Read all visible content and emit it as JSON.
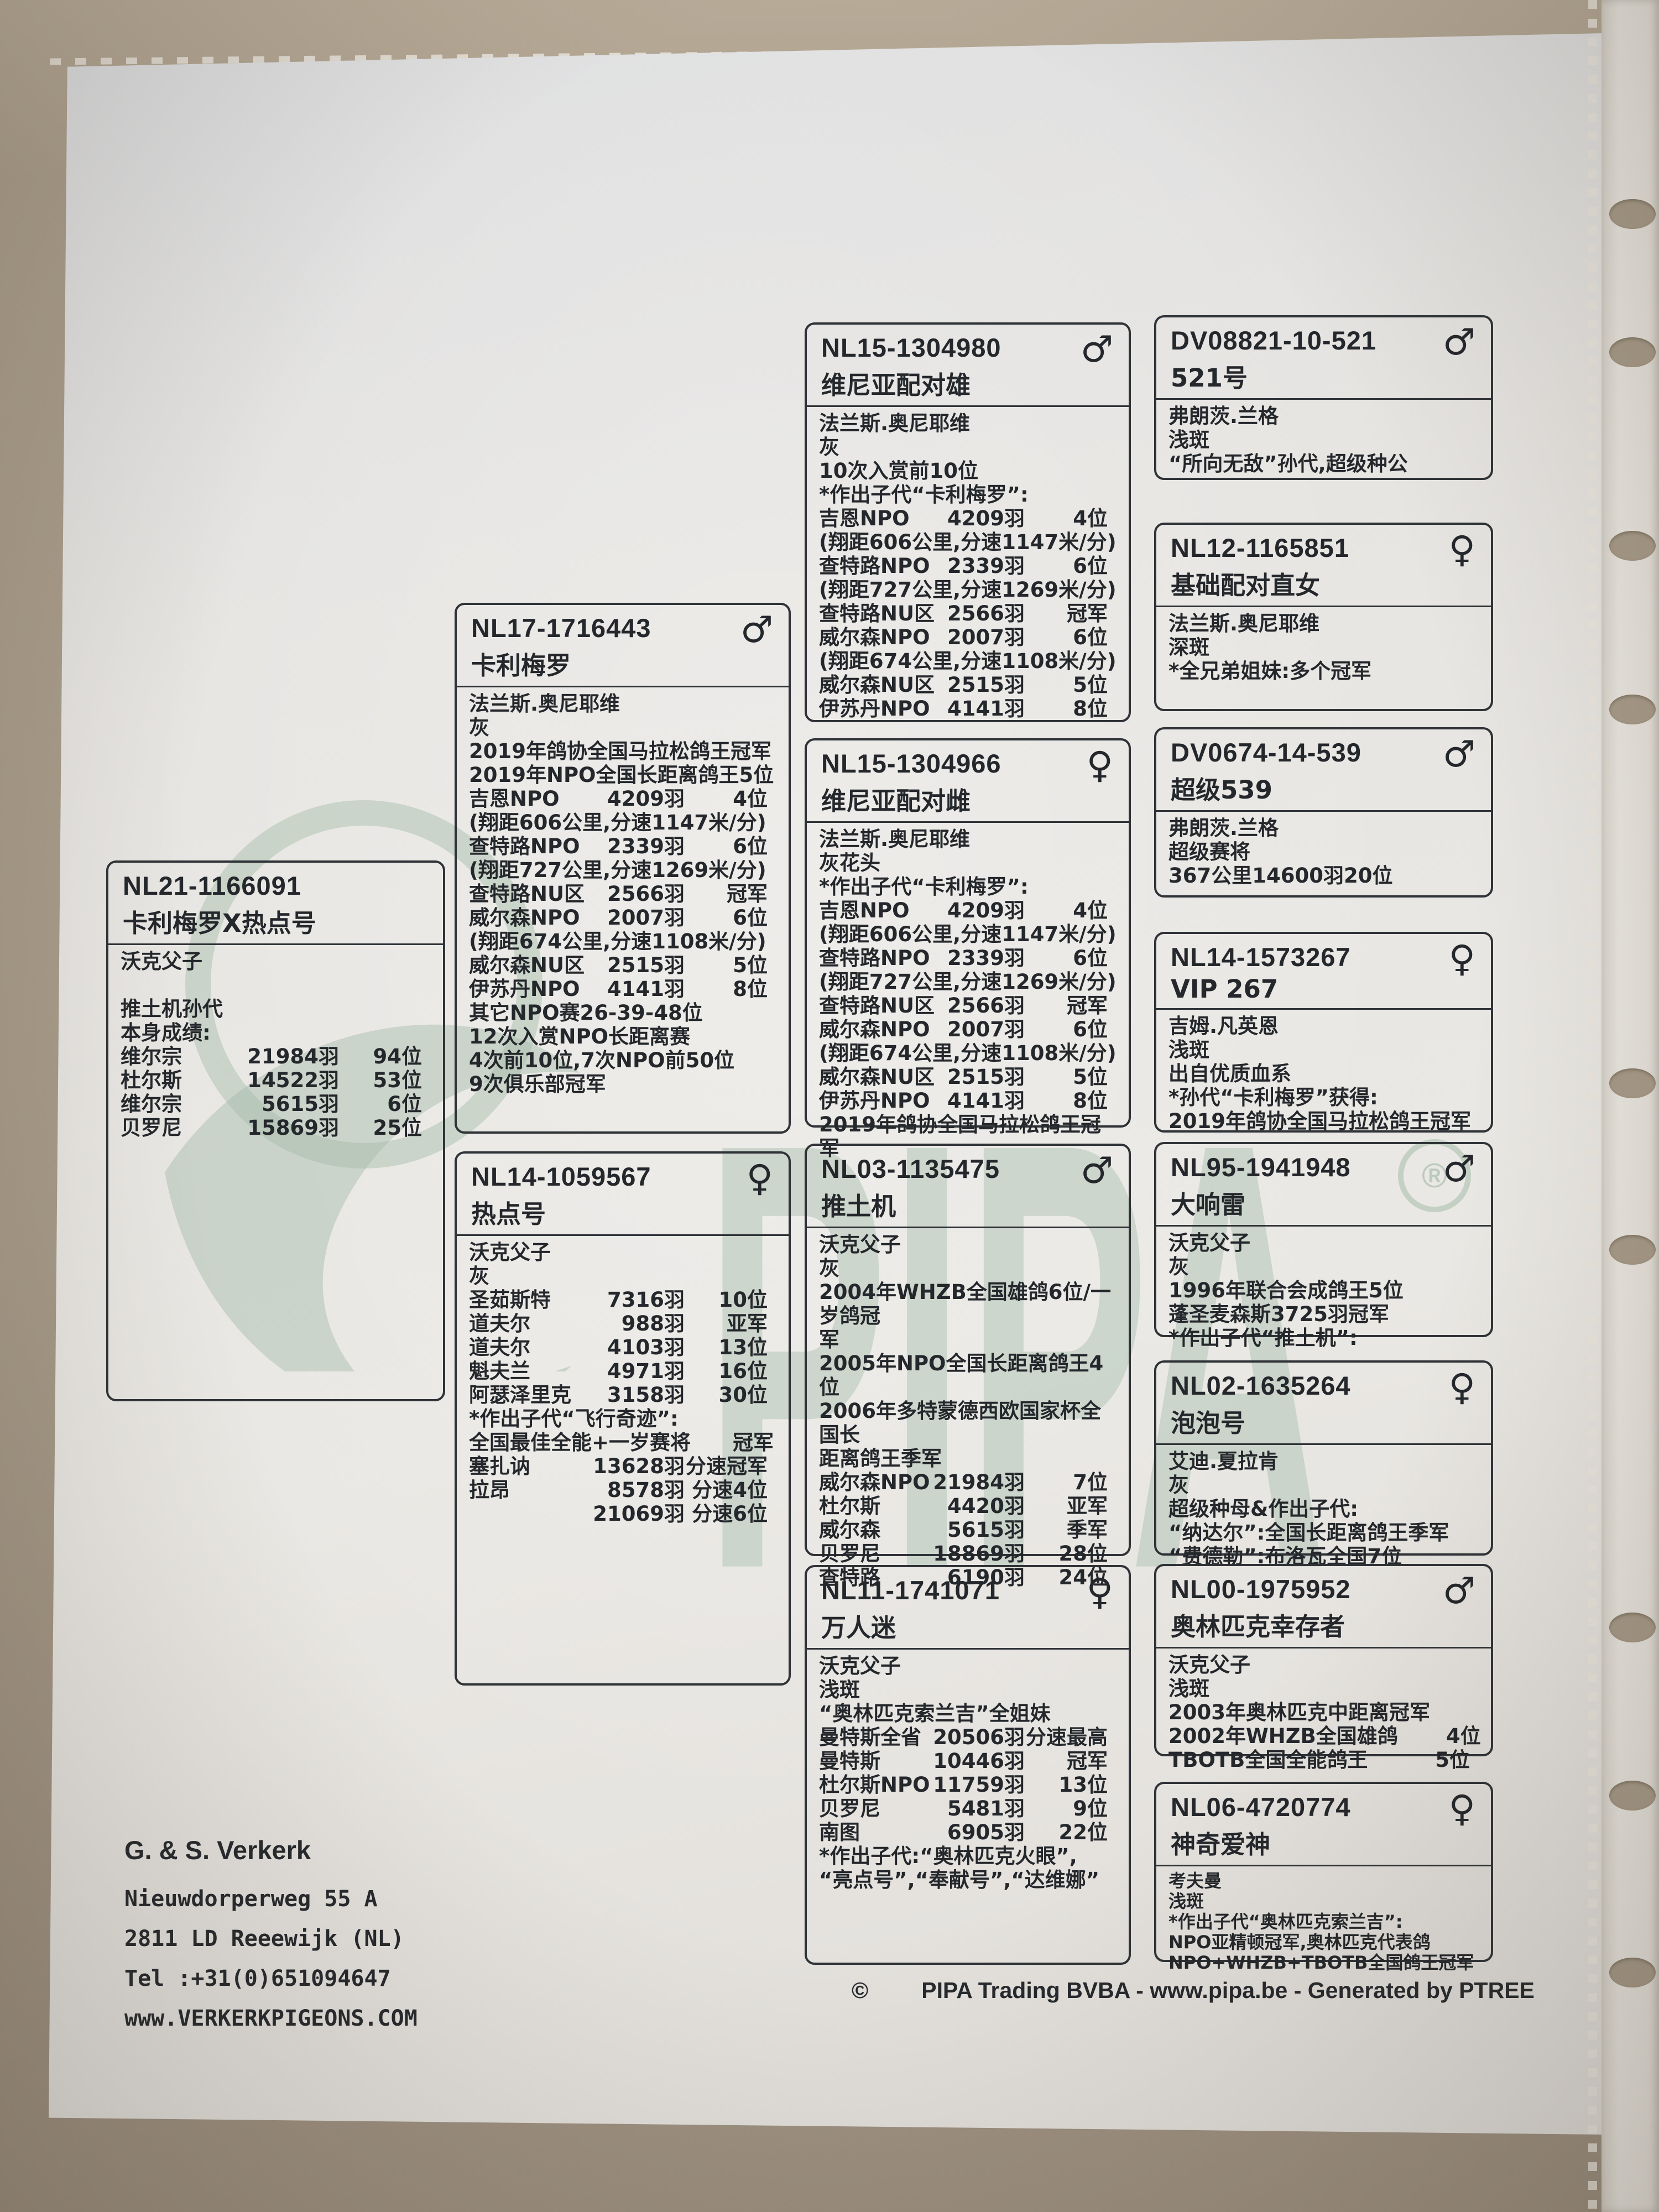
{
  "watermark": {
    "brand": "PIPA",
    "registered": "®"
  },
  "owner": {
    "name": "G. & S. Verkerk",
    "lines": [
      "Nieuwdorperweg 55 A",
      "2811 LD Reeewijk (NL)",
      "Tel :+31(0)651094647",
      "www.VERKERKPIGEONS.COM"
    ]
  },
  "footer": {
    "copyright": "©",
    "text": "PIPA Trading BVBA - www.pipa.be - Generated by PTREE"
  },
  "boxes": [
    {
      "id": "NL21-1166091",
      "title": "卡利梅罗X热点号",
      "sex": "",
      "lines": [
        {
          "t": "沃克父子"
        },
        {
          "t": ""
        },
        {
          "t": "推土机孙代"
        },
        {
          "t": "本身成绩:"
        },
        {
          "c": [
            "维尔宗",
            "21984羽",
            "94位"
          ]
        },
        {
          "c": [
            "杜尔斯",
            "14522羽",
            "53位"
          ]
        },
        {
          "c": [
            "维尔宗",
            "5615羽",
            "6位"
          ]
        },
        {
          "c": [
            "贝罗尼",
            "15869羽",
            "25位"
          ]
        }
      ]
    },
    {
      "id": "NL17-1716443",
      "title": "卡利梅罗",
      "sex": "♂",
      "lines": [
        {
          "t": "法兰斯.奥尼耶维"
        },
        {
          "t": "灰"
        },
        {
          "t": "2019年鸽协全国马拉松鸽王冠军"
        },
        {
          "t": "2019年NPO全国长距离鸽王5位"
        },
        {
          "c": [
            "吉恩NPO",
            "4209羽",
            "4位"
          ]
        },
        {
          "t": "(翔距606公里,分速1147米/分)"
        },
        {
          "c": [
            "查特路NPO",
            "2339羽",
            "6位"
          ]
        },
        {
          "t": "(翔距727公里,分速1269米/分)"
        },
        {
          "c": [
            "查特路NU区",
            "2566羽",
            "冠军"
          ]
        },
        {
          "c": [
            "威尔森NPO",
            "2007羽",
            "6位"
          ]
        },
        {
          "t": "(翔距674公里,分速1108米/分)"
        },
        {
          "c": [
            "威尔森NU区",
            "2515羽",
            "5位"
          ]
        },
        {
          "c": [
            "伊苏丹NPO",
            "4141羽",
            "8位"
          ]
        },
        {
          "t": "其它NPO赛26-39-48位"
        },
        {
          "t": "12次入赏NPO长距离赛"
        },
        {
          "t": "4次前10位,7次NPO前50位"
        },
        {
          "t": "9次俱乐部冠军"
        }
      ]
    },
    {
      "id": "NL14-1059567",
      "title": "热点号",
      "sex": "♀",
      "lines": [
        {
          "t": "沃克父子"
        },
        {
          "t": "灰"
        },
        {
          "c": [
            "圣茹斯特",
            "7316羽",
            "10位"
          ]
        },
        {
          "c": [
            "道夫尔",
            "988羽",
            "亚军"
          ]
        },
        {
          "c": [
            "道夫尔",
            "4103羽",
            "13位"
          ]
        },
        {
          "c": [
            "魁夫兰",
            "4971羽",
            "16位"
          ]
        },
        {
          "c": [
            "阿瑟泽里克",
            "3158羽",
            "30位"
          ]
        },
        {
          "t": "*作出子代“飞行奇迹”:"
        },
        {
          "c": [
            "全国最佳全能+一岁赛将",
            "",
            "冠军"
          ]
        },
        {
          "c": [
            "塞扎讷",
            "13628羽",
            "分速冠军"
          ]
        },
        {
          "c": [
            "拉昂",
            "8578羽",
            "分速4位"
          ]
        },
        {
          "c": [
            "",
            "21069羽",
            "分速6位"
          ]
        }
      ]
    },
    {
      "id": "NL15-1304980",
      "title": "维尼亚配对雄",
      "sex": "♂",
      "lines": [
        {
          "t": "法兰斯.奥尼耶维"
        },
        {
          "t": "灰"
        },
        {
          "t": "10次入赏前10位"
        },
        {
          "t": "*作出子代“卡利梅罗”:"
        },
        {
          "c": [
            "吉恩NPO",
            "4209羽",
            "4位"
          ]
        },
        {
          "t": "(翔距606公里,分速1147米/分)"
        },
        {
          "c": [
            "查特路NPO",
            "2339羽",
            "6位"
          ]
        },
        {
          "t": "(翔距727公里,分速1269米/分)"
        },
        {
          "c": [
            "查特路NU区",
            "2566羽",
            "冠军"
          ]
        },
        {
          "c": [
            "威尔森NPO",
            "2007羽",
            "6位"
          ]
        },
        {
          "t": "(翔距674公里,分速1108米/分)"
        },
        {
          "c": [
            "威尔森NU区",
            "2515羽",
            "5位"
          ]
        },
        {
          "c": [
            "伊苏丹NPO",
            "4141羽",
            "8位"
          ]
        }
      ]
    },
    {
      "id": "NL15-1304966",
      "title": "维尼亚配对雌",
      "sex": "♀",
      "lines": [
        {
          "t": "法兰斯.奥尼耶维"
        },
        {
          "t": "灰花头"
        },
        {
          "t": "*作出子代“卡利梅罗”:"
        },
        {
          "c": [
            "吉恩NPO",
            "4209羽",
            "4位"
          ]
        },
        {
          "t": "(翔距606公里,分速1147米/分)"
        },
        {
          "c": [
            "查特路NPO",
            "2339羽",
            "6位"
          ]
        },
        {
          "t": "(翔距727公里,分速1269米/分)"
        },
        {
          "c": [
            "查特路NU区",
            "2566羽",
            "冠军"
          ]
        },
        {
          "c": [
            "威尔森NPO",
            "2007羽",
            "6位"
          ]
        },
        {
          "t": "(翔距674公里,分速1108米/分)"
        },
        {
          "c": [
            "威尔森NU区",
            "2515羽",
            "5位"
          ]
        },
        {
          "c": [
            "伊苏丹NPO",
            "4141羽",
            "8位"
          ]
        },
        {
          "t": "2019年鸽协全国马拉松鸽王冠军"
        }
      ]
    },
    {
      "id": "NL03-1135475",
      "title": "推土机",
      "sex": "♂",
      "lines": [
        {
          "t": "沃克父子"
        },
        {
          "t": "灰"
        },
        {
          "t": "2004年WHZB全国雄鸽6位/一岁鸽冠"
        },
        {
          "t": "军"
        },
        {
          "t": "2005年NPO全国长距离鸽王4位"
        },
        {
          "t": "2006年多特蒙德西欧国家杯全国长"
        },
        {
          "t": "距离鸽王季军"
        },
        {
          "c": [
            "威尔森NPO",
            "21984羽",
            "7位"
          ]
        },
        {
          "c": [
            "杜尔斯",
            "4420羽",
            "亚军"
          ]
        },
        {
          "c": [
            "威尔森",
            "5615羽",
            "季军"
          ]
        },
        {
          "c": [
            "贝罗尼",
            "18869羽",
            "28位"
          ]
        },
        {
          "c": [
            "查特路",
            "6190羽",
            "24位"
          ]
        }
      ]
    },
    {
      "id": "NL11-1741071",
      "title": "万人迷",
      "sex": "♀",
      "lines": [
        {
          "t": "沃克父子"
        },
        {
          "t": "浅斑"
        },
        {
          "t": "“奥林匹克索兰吉”全姐妹"
        },
        {
          "c": [
            "曼特斯全省",
            "20506羽",
            "分速最高"
          ]
        },
        {
          "c": [
            "曼特斯",
            "10446羽",
            "冠军"
          ]
        },
        {
          "c": [
            "杜尔斯NPO",
            "11759羽",
            "13位"
          ]
        },
        {
          "c": [
            "贝罗尼",
            "5481羽",
            "9位"
          ]
        },
        {
          "c": [
            "南图",
            "6905羽",
            "22位"
          ]
        },
        {
          "t": "*作出子代:“奥林匹克火眼”,"
        },
        {
          "t": "“亮点号”,“奉献号”,“达维娜”"
        }
      ]
    },
    {
      "id": "DV08821-10-521",
      "title": "521号",
      "sex": "♂",
      "lines": [
        {
          "t": "弗朗茨.兰格"
        },
        {
          "t": "浅斑"
        },
        {
          "t": "“所向无敌”孙代,超级种公"
        }
      ]
    },
    {
      "id": "NL12-1165851",
      "title": "基础配对直女",
      "sex": "♀",
      "lines": [
        {
          "t": "法兰斯.奥尼耶维"
        },
        {
          "t": "深斑"
        },
        {
          "t": "*全兄弟姐妹:多个冠军"
        }
      ]
    },
    {
      "id": "DV0674-14-539",
      "title": "超级539",
      "sex": "♂",
      "lines": [
        {
          "t": "弗朗茨.兰格"
        },
        {
          "t": "超级赛将"
        },
        {
          "t": "367公里14600羽20位"
        }
      ]
    },
    {
      "id": "NL14-1573267",
      "title": "VIP 267",
      "sex": "♀",
      "lines": [
        {
          "t": "吉姆.凡英恩"
        },
        {
          "t": "浅斑"
        },
        {
          "t": "出自优质血系"
        },
        {
          "t": "*孙代“卡利梅罗”获得:"
        },
        {
          "t": "2019年鸽协全国马拉松鸽王冠军"
        }
      ]
    },
    {
      "id": "NL95-1941948",
      "title": "大响雷",
      "sex": "♂",
      "lines": [
        {
          "t": "沃克父子"
        },
        {
          "t": "灰"
        },
        {
          "t": "1996年联合会成鸽王5位"
        },
        {
          "t": "蓬圣麦森斯3725羽冠军"
        },
        {
          "t": "*作出子代“推土机”:"
        }
      ]
    },
    {
      "id": "NL02-1635264",
      "title": "泡泡号",
      "sex": "♀",
      "lines": [
        {
          "t": "艾迪.夏拉肯"
        },
        {
          "t": "灰"
        },
        {
          "t": "超级种母&作出子代:"
        },
        {
          "t": "“纳达尔”:全国长距离鸽王季军"
        },
        {
          "t": "“费德勒”:布洛瓦全国7位"
        }
      ]
    },
    {
      "id": "NL00-1975952",
      "title": "奥林匹克幸存者",
      "sex": "♂",
      "lines": [
        {
          "t": "沃克父子"
        },
        {
          "t": "浅斑"
        },
        {
          "t": "2003年奥林匹克中距离冠军"
        },
        {
          "c": [
            "2002年WHZB全国雄鸽",
            "",
            "4位"
          ]
        },
        {
          "c": [
            "TBOTB全国全能鸽王",
            "",
            "5位"
          ]
        }
      ]
    },
    {
      "id": "NL06-4720774",
      "title": "神奇爱神",
      "sex": "♀",
      "lines": [
        {
          "t": "考夫曼"
        },
        {
          "t": "浅斑"
        },
        {
          "t": "*作出子代“奥林匹克索兰吉”:"
        },
        {
          "t": "NPO亚精顿冠军,奥林匹克代表鸽"
        },
        {
          "t": "NPO+WHZB+TBOTB全国鸽王冠军"
        }
      ]
    }
  ]
}
